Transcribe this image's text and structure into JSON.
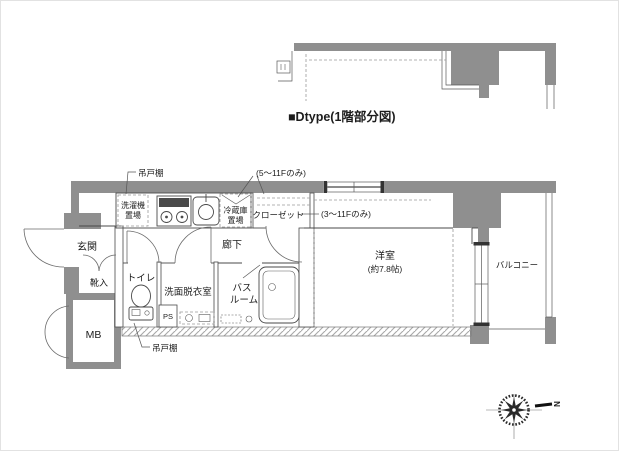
{
  "title": "■Dtype(1階部分図)",
  "plan": {
    "rooms": {
      "genkan": "玄関",
      "shoe_box": "靴入",
      "toilet": "トイレ",
      "washroom": "洗面脱衣室",
      "bath_line1": "バス",
      "bath_line2": "ルーム",
      "hallway": "廊下",
      "bedroom_line1": "洋室",
      "bedroom_line2": "(約7.8帖)",
      "balcony": "バルコニー",
      "meter_box": "MB",
      "pipe_space": "PS"
    },
    "equipment": {
      "laundry_line1": "洗濯機",
      "laundry_line2": "置場",
      "fridge_line1": "冷蔵庫",
      "fridge_line2": "置場",
      "closet": "クローゼット"
    },
    "annotations": {
      "hanging_cabinet_top": "吊戸棚",
      "hanging_cabinet_bottom": "吊戸棚",
      "floors_5_to_11": "(5〜11Fのみ)",
      "floors_3_to_11": "(3〜11Fのみ)"
    },
    "compass": {
      "north": "N"
    }
  },
  "colors": {
    "wall_gray": "#8f8f8f",
    "line_dark": "#4a4a4a",
    "background": "#ffffff"
  }
}
